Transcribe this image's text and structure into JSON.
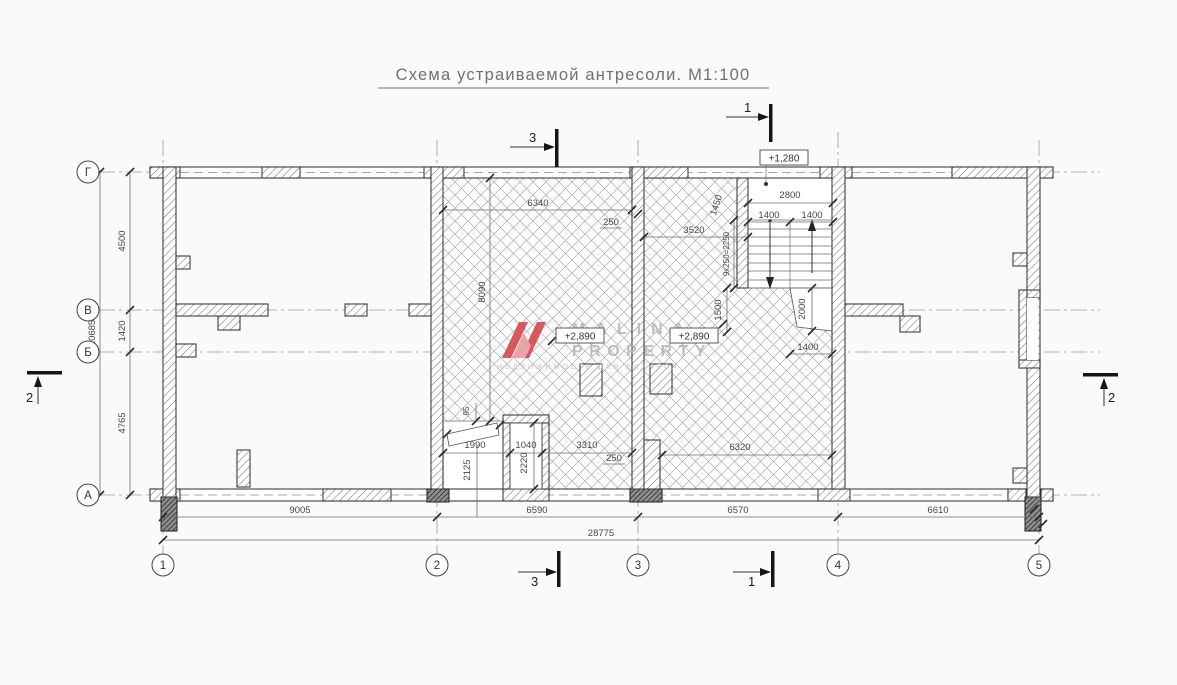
{
  "title": "Схема устраиваемой антресоли. М1:100",
  "axes": {
    "rows": [
      "Г",
      "В",
      "Б",
      "А"
    ],
    "cols": [
      "1",
      "2",
      "3",
      "4",
      "5"
    ]
  },
  "dims": {
    "left": [
      "4500",
      "1420",
      "4765"
    ],
    "left_total": "10685",
    "bottom": [
      "9005",
      "6590",
      "6570",
      "6610"
    ],
    "bottom_total": "28775",
    "room23_top": "6340",
    "wall_250_top": "250",
    "room34_top": "3520",
    "stair_side": "1450",
    "stair_width": "2800",
    "stair_flight_left": "1400",
    "stair_flight_right": "1400",
    "stair_run": "9x250=2250",
    "stair_1500": "1500",
    "under_stair_2000": "2000",
    "under_stair_1400": "1400",
    "door_1990": "1990",
    "shaft_1040": "1040",
    "sill_3310": "3310",
    "wall_250_bottom": "250",
    "room34_bottom": "6320",
    "door_h_2125": "2125",
    "shaft_h_2220": "2220",
    "gap_95": "95",
    "room23_h_8090": "8090"
  },
  "levels": {
    "stair_landing": "+1,280",
    "mezz_left": "+2,890",
    "mezz_right": "+2,890"
  },
  "sections": {
    "s1": "1",
    "s2": "2",
    "s3": "3"
  },
  "watermark": {
    "brand_line1": "MALINA",
    "brand_line2": "PROPERTY",
    "tagline": "НЕДВИЖИМОСТЬ ДЛЯ БИЗНЕСА"
  },
  "colors": {
    "accent_red": "#d4494d",
    "line": "#3e3e3e",
    "dim_text": "#474747"
  }
}
